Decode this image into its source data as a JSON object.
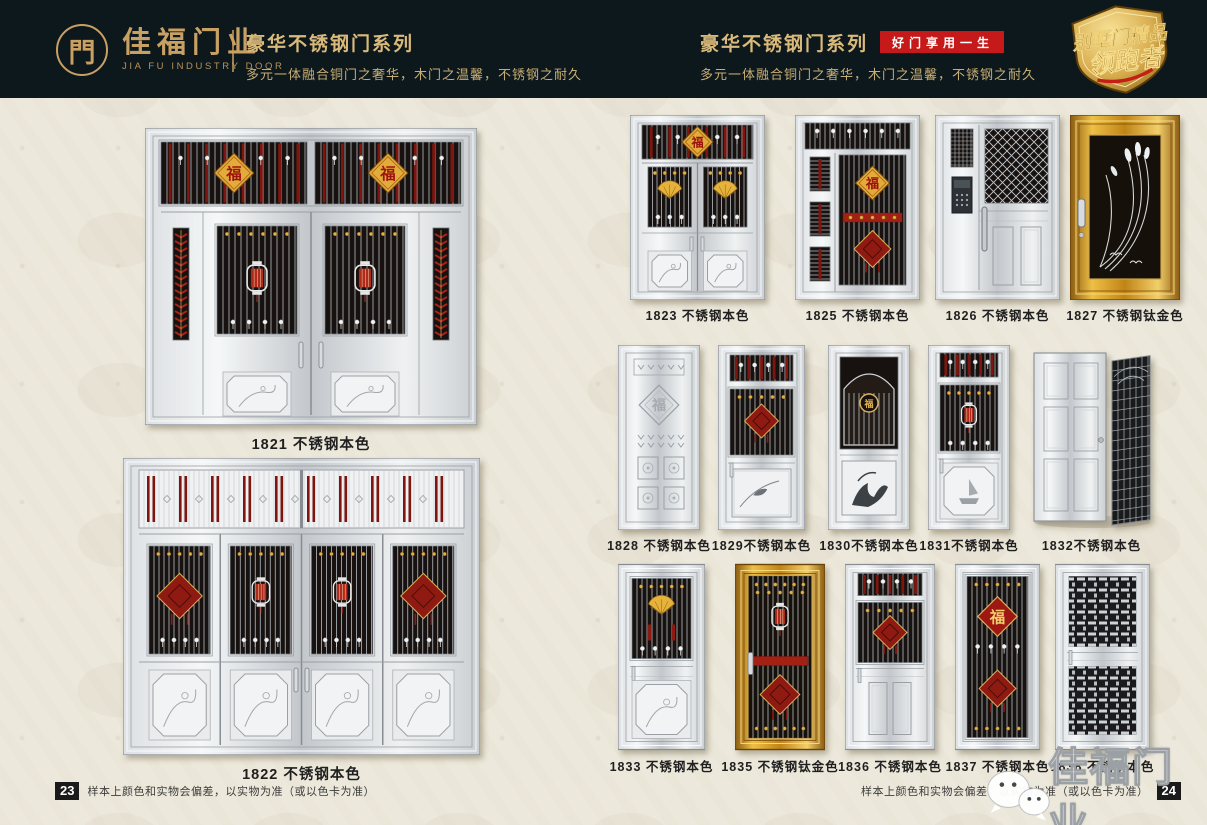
{
  "colors": {
    "header_bg": "#0d181d",
    "gold": "#c9a063",
    "badge_red": "#c61a1a",
    "page_bg": "#ece8db"
  },
  "header": {
    "logo_symbol": "門",
    "logo_name": "佳福门业",
    "logo_sub": "JIA FU INDUSTRY DOOR",
    "left_title": "豪华不锈钢门系列",
    "left_subtitle": "多元一体融合铜门之奢华，木门之温馨，不锈钢之耐久",
    "right_title": "豪华不锈钢门系列",
    "quality_badge": "好门享用一生",
    "right_subtitle": "多元一体融合铜门之奢华，木门之温馨，不锈钢之耐久",
    "shield_line1": "别墅门精品",
    "shield_line2": "领跑者"
  },
  "doors": [
    {
      "id": "1821",
      "label": "1821 不锈钢本色",
      "kind": "d1821"
    },
    {
      "id": "1822",
      "label": "1822 不锈钢本色",
      "kind": "d1822"
    },
    {
      "id": "1823",
      "label": "1823 不锈钢本色",
      "kind": "d1823"
    },
    {
      "id": "1825",
      "label": "1825 不锈钢本色",
      "kind": "d1825"
    },
    {
      "id": "1826",
      "label": "1826 不锈钢本色",
      "kind": "d1826"
    },
    {
      "id": "1827",
      "label": "1827 不锈钢钛金色",
      "kind": "d1827"
    },
    {
      "id": "1828",
      "label": "1828 不锈钢本色",
      "kind": "d1828"
    },
    {
      "id": "1829",
      "label": "1829不锈钢本色",
      "kind": "d1829"
    },
    {
      "id": "1830",
      "label": "1830不锈钢本色",
      "kind": "d1830"
    },
    {
      "id": "1831",
      "label": "1831不锈钢本色",
      "kind": "d1831"
    },
    {
      "id": "1832",
      "label": "1832不锈钢本色",
      "kind": "d1832"
    },
    {
      "id": "1833",
      "label": "1833 不锈钢本色",
      "kind": "d1833"
    },
    {
      "id": "1835",
      "label": "1835 不锈钢钛金色",
      "kind": "d1835"
    },
    {
      "id": "1836",
      "label": "1836 不锈钢本色",
      "kind": "d1836"
    },
    {
      "id": "1837",
      "label": "1837 不锈钢本色",
      "kind": "d1837"
    },
    {
      "id": "1838",
      "label": "1838 不锈钢本色",
      "kind": "d1838"
    }
  ],
  "footer": {
    "left_page_no": "23",
    "right_page_no": "24",
    "note": "样本上颜色和实物会偏差，以实物为准（或以色卡为准）"
  },
  "watermark": {
    "text": "佳福门业"
  }
}
